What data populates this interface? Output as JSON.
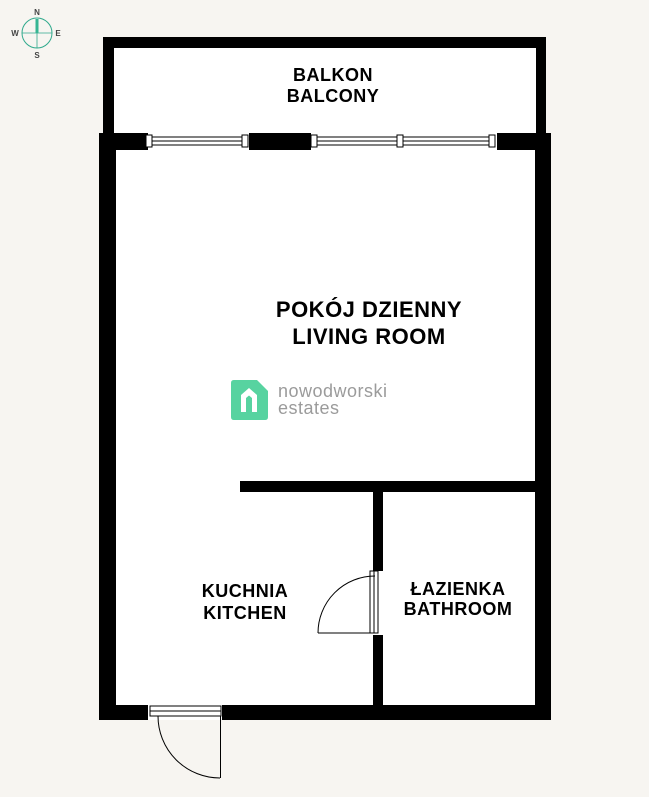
{
  "title": "Apartment floor plan",
  "compass": {
    "north": "N",
    "east": "E",
    "south": "S",
    "west": "W",
    "ring_color": "#2fa98c",
    "needle_color": "#36b593",
    "letter_color": "#444444"
  },
  "rooms": {
    "balcony": {
      "label_pl": "BALKON",
      "label_en": "BALCONY"
    },
    "living": {
      "label_pl": "POKÓJ DZIENNY",
      "label_en": "LIVING ROOM"
    },
    "kitchen": {
      "label_pl": "KUCHNIA",
      "label_en": "KITCHEN"
    },
    "bathroom": {
      "label_pl": "ŁAZIENKA",
      "label_en": "BATHROOM"
    }
  },
  "logo": {
    "line1": "nowodworski",
    "line2": "estates",
    "mark_color": "#57d3a0",
    "text_color": "#9b9b9b"
  },
  "colors": {
    "background": "#f7f5f1",
    "wall": "#000000",
    "room_fill": "#ffffff"
  }
}
